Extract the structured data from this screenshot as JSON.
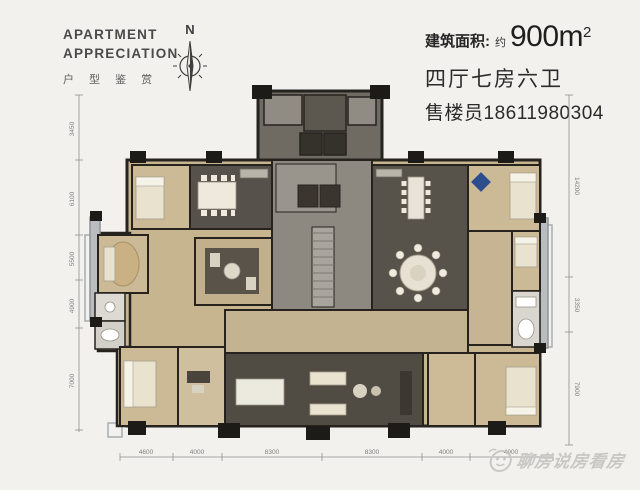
{
  "header": {
    "title_line1": "APARTMENT",
    "title_line2": "APPRECIATION",
    "subtitle": "户 型 鉴 赏",
    "compass_label": "N"
  },
  "info": {
    "area_label": "建筑面积:",
    "area_approx": "约",
    "area_value": "900m",
    "area_exponent": "2",
    "rooms_text": "四厅七房六卫",
    "agent_text": "售楼员18611980304"
  },
  "floorplan": {
    "dims_left": [
      "3450",
      "6100",
      "5500",
      "4900",
      "7000"
    ],
    "dims_right": [
      "14200",
      "3350",
      "7900"
    ],
    "dims_bottom": [
      "4600",
      "4000",
      "8300",
      "8300",
      "4000",
      "4900"
    ]
  },
  "watermark": {
    "text": "聊房说房看房"
  },
  "colors": {
    "background": "#f2f1ee",
    "wall": "#26231f",
    "wood_floor": "#c7b590",
    "dark_floor": "#56514a",
    "core_gray": "#8d8880",
    "fixture_white": "#e9e3d2",
    "accent_blue": "#2d4d8d",
    "text_dark": "#262626",
    "dim_gray": "#8f8f8f",
    "watermark_gray": "#c7c7c4"
  }
}
